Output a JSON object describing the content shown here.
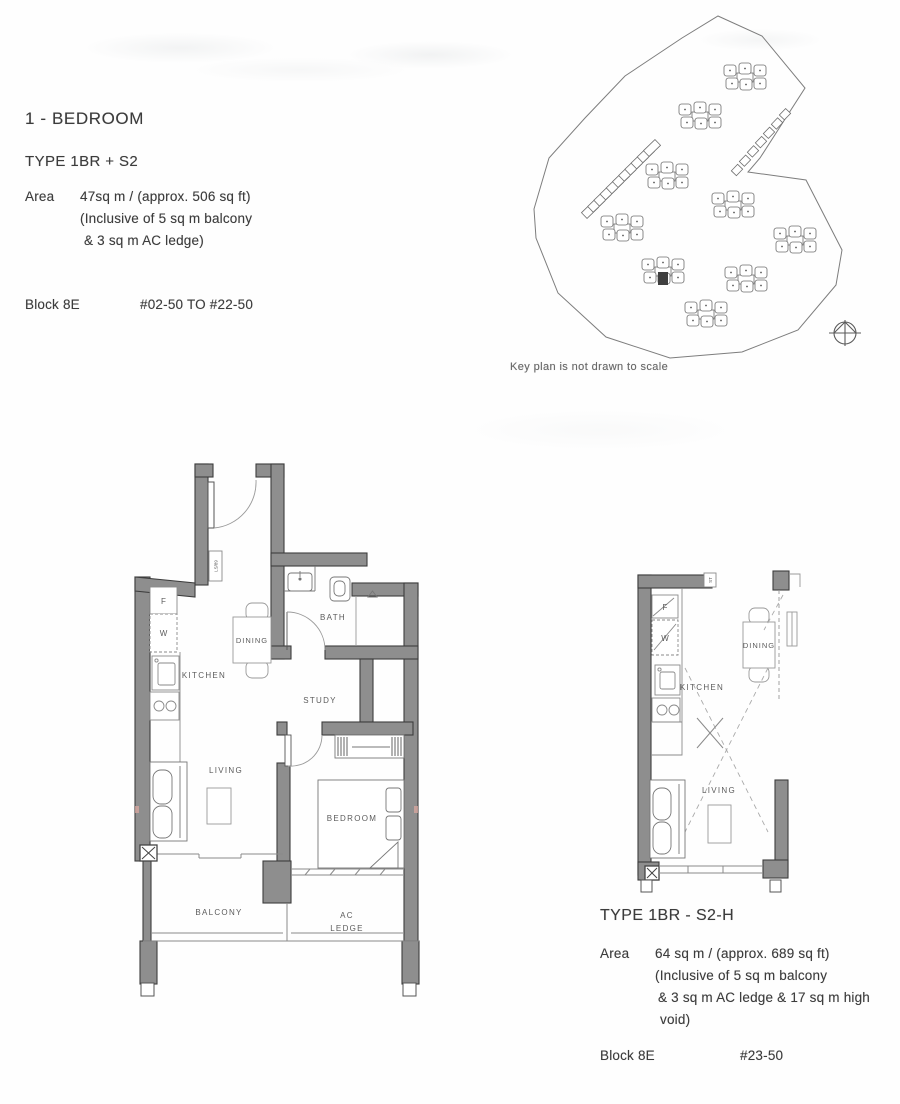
{
  "header": {
    "title": "1 - BEDROOM"
  },
  "plan_a": {
    "type_label": "TYPE 1BR + S2",
    "area_label": "Area",
    "area_lines": [
      "47sq m / (approx. 506 sq ft)",
      "(Inclusive of 5 sq m balcony",
      "& 3 sq m AC ledge)"
    ],
    "block_label": "Block 8E",
    "unit_range": "#02-50 TO #22-50",
    "rooms": {
      "kitchen": "KITCHEN",
      "dining": "DINING",
      "bath": "BATH",
      "study": "STUDY",
      "living": "LIVING",
      "bedroom": "BEDROOM",
      "balcony": "BALCONY",
      "ac_line1": "AC",
      "ac_line2": "LEDGE"
    },
    "fixtures": {
      "fridge": "F",
      "washer": "W"
    },
    "wall_tag": "LS/89"
  },
  "plan_b": {
    "type_label": "TYPE 1BR - S2-H",
    "area_label": "Area",
    "area_lines": [
      "64 sq m / (approx. 689 sq ft)",
      "(Inclusive of 5 sq m balcony",
      "& 3 sq m AC ledge & 17 sq m high",
      "void)"
    ],
    "block_label": "Block 8E",
    "unit_range": "#23-50",
    "rooms": {
      "kitchen": "KITCHEN",
      "dining": "DINING",
      "living": "LIVING"
    },
    "fixtures": {
      "fridge": "F",
      "washer": "W"
    },
    "wall_tag": "ST"
  },
  "keyplan": {
    "caption": "Key plan is not drawn to scale"
  },
  "colors": {
    "wall": "#8e8e8e",
    "wall_edge": "#3d3d3d",
    "thin_line": "#8a8a8a",
    "text": "#3c3c3c",
    "highlight_unit": "#3f3f3f"
  }
}
